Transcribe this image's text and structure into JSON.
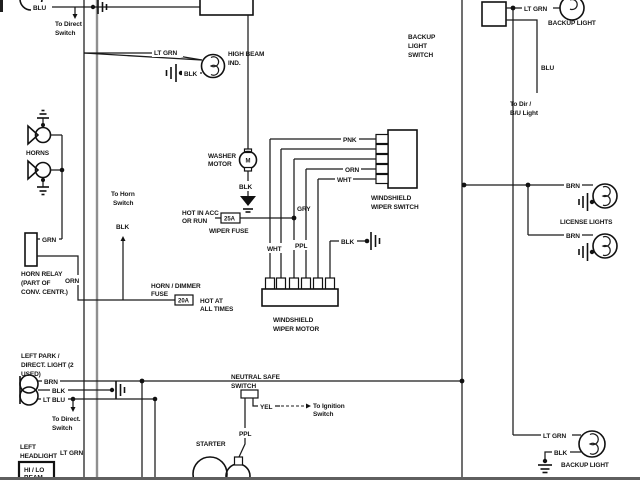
{
  "colors": {
    "line": "#1b1b1b",
    "bus_gray": "#8f8f8f",
    "paper": "#ffffff"
  },
  "d": {
    "top_left": {
      "blu": "BLU",
      "to1": "To Direct",
      "to2": "Switch"
    },
    "high_beam": {
      "wire": "LT GRN",
      "name1": "HIGH BEAM",
      "name2": "IND.",
      "blk": "BLK"
    },
    "horns": {
      "name": "HORNS"
    },
    "horn_relay": {
      "grn": "GRN",
      "orn": "ORN",
      "name1": "HORN RELAY",
      "name2": "(PART OF",
      "name3": "CONV. CENTR.)"
    },
    "horn_switch": {
      "to1": "To Horn",
      "to2": "Switch",
      "blk": "BLK"
    },
    "horn_fuse": {
      "name1": "HORN / DIMMER",
      "name2": "FUSE",
      "amps": "20A",
      "hot1": "HOT AT",
      "hot2": "ALL TIMES"
    },
    "wiper_fuse": {
      "hot1": "HOT IN ACC",
      "hot2": "OR RUN",
      "amps": "25A",
      "name": "WIPER FUSE"
    },
    "washer_motor": {
      "name1": "WASHER",
      "name2": "MOTOR",
      "m": "M",
      "blk": "BLK"
    },
    "wiper_switch": {
      "pnk": "PNK",
      "gry": "GRY",
      "orn": "ORN",
      "wht": "WHT",
      "name1": "WINDSHIELD",
      "name2": "WIPER SWITCH"
    },
    "wiper_motor": {
      "wht": "WHT",
      "ppl": "PPL",
      "blk": "BLK",
      "name1": "WINDSHIELD",
      "name2": "WIPER MOTOR"
    },
    "backup_switch": {
      "name1": "BACKUP",
      "name2": "LIGHT",
      "name3": "SWITCH",
      "blu": "BLU",
      "to1": "To Dir /",
      "to2": "B/U Light"
    },
    "backup_light_top": {
      "wire": "LT GRN",
      "name": "BACKUP LIGHT"
    },
    "license_lights": {
      "brn1": "BRN",
      "brn2": "BRN",
      "name": "LICENSE LIGHTS"
    },
    "backup_light_bottom": {
      "wire": "LT GRN",
      "blk": "BLK",
      "name": "BACKUP LIGHT"
    },
    "park_light": {
      "name1": "LEFT PARK /",
      "name2": "DIRECT. LIGHT (2",
      "name3": "USED)",
      "brn": "BRN",
      "blk": "BLK",
      "ltblu": "LT BLU",
      "to1": "To Direct.",
      "to2": "Switch"
    },
    "headlight": {
      "name1": "LEFT",
      "name2": "HEADLIGHT",
      "wire": "LT GRN",
      "beam1": "HI / LO",
      "beam2": "BEAM"
    },
    "neutral_safe": {
      "name1": "NEUTRAL SAFE",
      "name2": "SWITCH",
      "yel": "YEL",
      "to1": "To Ignition",
      "to2": "Switch",
      "ppl": "PPL"
    },
    "starter": {
      "name": "STARTER"
    }
  }
}
